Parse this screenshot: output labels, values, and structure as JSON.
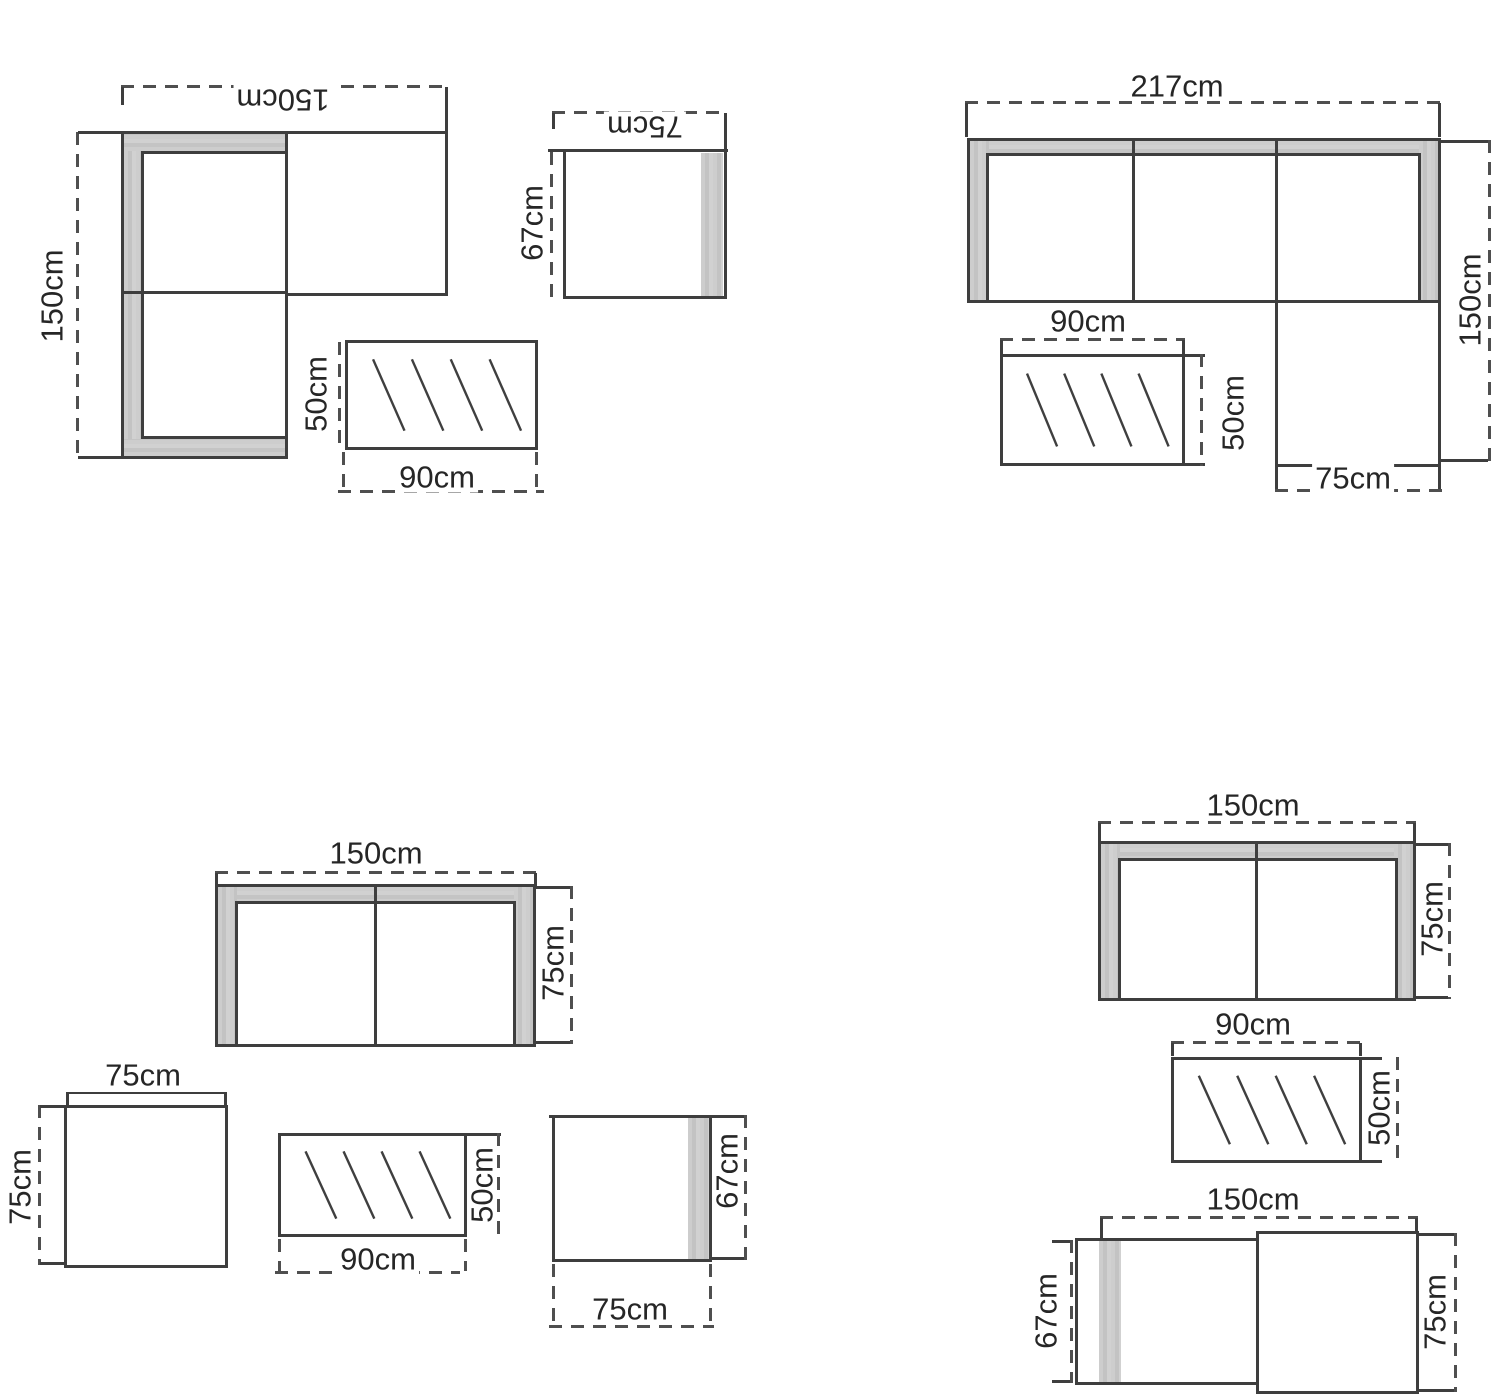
{
  "colors": {
    "line": "#3e3e3e",
    "dash": "#4f4f4f",
    "upholstery_gray": "#c8c8c8"
  },
  "sets": {
    "corner_sofa_set": {
      "sofa": {
        "width": "150cm",
        "depth": "150cm"
      },
      "armchair": {
        "width": "75cm",
        "depth": "67cm"
      },
      "glass_table": {
        "width": "90cm",
        "depth": "50cm"
      }
    },
    "chaise_sofa_set": {
      "sofa": {
        "width": "217cm",
        "depth": "150cm",
        "chaise_width": "75cm"
      },
      "glass_table": {
        "width": "90cm",
        "depth": "50cm"
      }
    },
    "two_seater_set": {
      "sofa": {
        "width": "150cm",
        "depth": "75cm"
      },
      "bench": {
        "width": "75cm",
        "depth": "75cm"
      },
      "glass_table": {
        "width": "90cm",
        "depth": "50cm"
      },
      "armchair": {
        "width": "75cm",
        "depth": "67cm"
      }
    },
    "two_seater_bench_set": {
      "sofa": {
        "width": "150cm",
        "depth": "75cm"
      },
      "glass_table": {
        "width": "90cm",
        "depth": "50cm"
      },
      "combo": {
        "width": "150cm",
        "chair_depth": "67cm",
        "bench_depth": "75cm"
      }
    }
  }
}
